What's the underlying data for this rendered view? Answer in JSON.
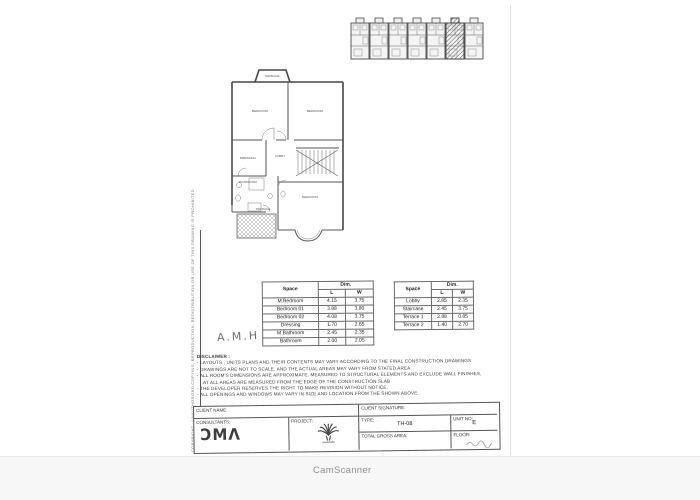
{
  "watermark": "CamScanner",
  "handwriting": {
    "initials": "A.M.H"
  },
  "side_note": {
    "copyright": "COPYRIGHT : UNAUTHORIZED COPYING, REPRODUCTION, REDISTRIBUTION OR USE OF THIS DRAWING IS PROHIBITED"
  },
  "floor_plan": {
    "labels": {
      "terrace_top": "TERRACE",
      "bedroom_tl": "BEDROOM",
      "bedroom_tr": "BEDROOM",
      "dressing": "DRESSING",
      "lobby": "LOBBY",
      "bathroom": "BATHROOM",
      "bedroom_bottom": "BEDROOM",
      "terrace_bottom": "TERRACE"
    }
  },
  "tables": {
    "rooms": {
      "header_space": "Space",
      "header_dim": "Dim.",
      "header_l": "L",
      "header_w": "W",
      "rows": [
        {
          "space": "M.Bedroom",
          "l": "4.15",
          "w": "3.75"
        },
        {
          "space": "Bedroom 01",
          "l": "3.88",
          "w": "3.80"
        },
        {
          "space": "Bedroom 02",
          "l": "4.08",
          "w": "3.75"
        },
        {
          "space": "Dressing",
          "l": "1.70",
          "w": "2.65"
        },
        {
          "space": "M.Bathroom",
          "l": "2.45",
          "w": "2.35"
        },
        {
          "space": "Bathroom",
          "l": "2.00",
          "w": "2.05"
        }
      ]
    },
    "areas": {
      "header_space": "Space",
      "header_dim": "Dim.",
      "header_l": "L",
      "header_w": "W",
      "rows": [
        {
          "space": "Lobby",
          "l": "2.85",
          "w": "2.35"
        },
        {
          "space": "Staircase",
          "l": "2.45",
          "w": "3.75"
        },
        {
          "space": "Terrace 1",
          "l": "2.88",
          "w": "0.85"
        },
        {
          "space": "Terrace 2",
          "l": "1.40",
          "w": "2.70"
        }
      ]
    }
  },
  "disclaimer": {
    "title": "DISCLAIMER :",
    "lines": [
      "- LAYOUTS , UNITS PLANS AND THEIR CONTENTS MAY VARY ACCORDING TO THE FINAL CONSTRUCTION DRAWINGS",
      "- DRAWINGS ARE NOT TO SCALE, AND THE ACTUAL AREAS MAY VARY FROM STATED AREA.",
      "- ALL ROOM'S DIMENSIONS ARE APPROXIMATE, MEASURED TO STRUCTURAL ELEMENTS AND EXCLUDE WALL FINISHES,",
      "AT ALL AREAS ARE MEASURED FROM THE EDGE OF THE CONSTRUCTION SLAB",
      "- THE DEVELOPER RESERVES THE RIGHT TO MAKE REVISION WITHOUT NOTICE.",
      "- ALL OPENINGS AND WINDOWS MAY VARY IN SIZE AND LOCATION FROM THE SHOWN ABOVE."
    ]
  },
  "title_block": {
    "client_name_label": "CLIENT NAME:",
    "client_signature_label": "CLIENT SIGNATURE:",
    "consultants_label": "CONSULTANTS:",
    "consultants_logo": "ƆMΛ",
    "project_label": "PROJECT:",
    "type_label": "TYPE:",
    "type_value": "TH-08",
    "unit_label": "UNIT NO:",
    "unit_value": "E",
    "total_area_label": "TOTAL GROSS AREA:",
    "floor_label": "FLOOR:"
  }
}
